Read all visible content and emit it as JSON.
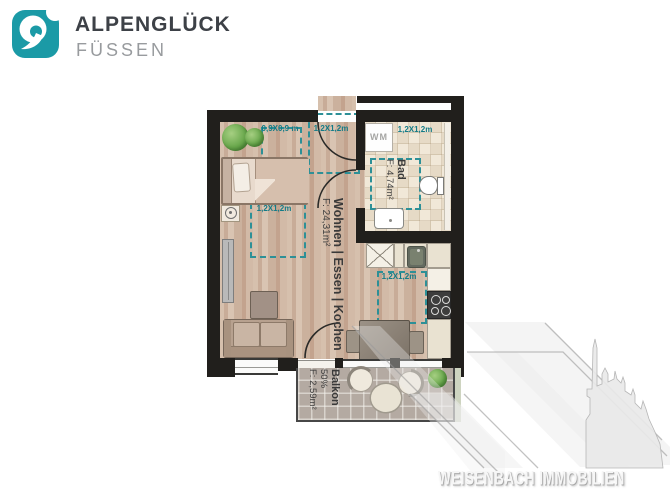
{
  "logo": {
    "title": "ALPENGLÜCK",
    "subtitle": "FÜSSEN"
  },
  "watermark": {
    "text": "WEISENBACH IMMOBILIEN"
  },
  "rooms": {
    "living": {
      "name": "Wohnen | Essen | Kochen",
      "area": "F: 24,31m²"
    },
    "bath": {
      "name": "Bad",
      "area": "F: 4,74m²"
    },
    "balcony": {
      "name": "Balkon",
      "share": "50%",
      "area": "F: 2,59m²"
    }
  },
  "dims": {
    "bed": "0,9X0,9 m",
    "entry": "1,2X1,2m",
    "bath": "1,2X1,2m",
    "living": "1,2X1,2m",
    "kitchen": "1,2X1,2m"
  },
  "appliances": {
    "wm": "WM"
  },
  "colors": {
    "brand_teal": "#1b9aa6",
    "dimension_teal": "#137b87",
    "wall_black": "#211f1c",
    "wood_floor": "#cdb3a0",
    "bath_tile": "#ebe0cf",
    "balcony_floor": "#b4aaa2"
  }
}
